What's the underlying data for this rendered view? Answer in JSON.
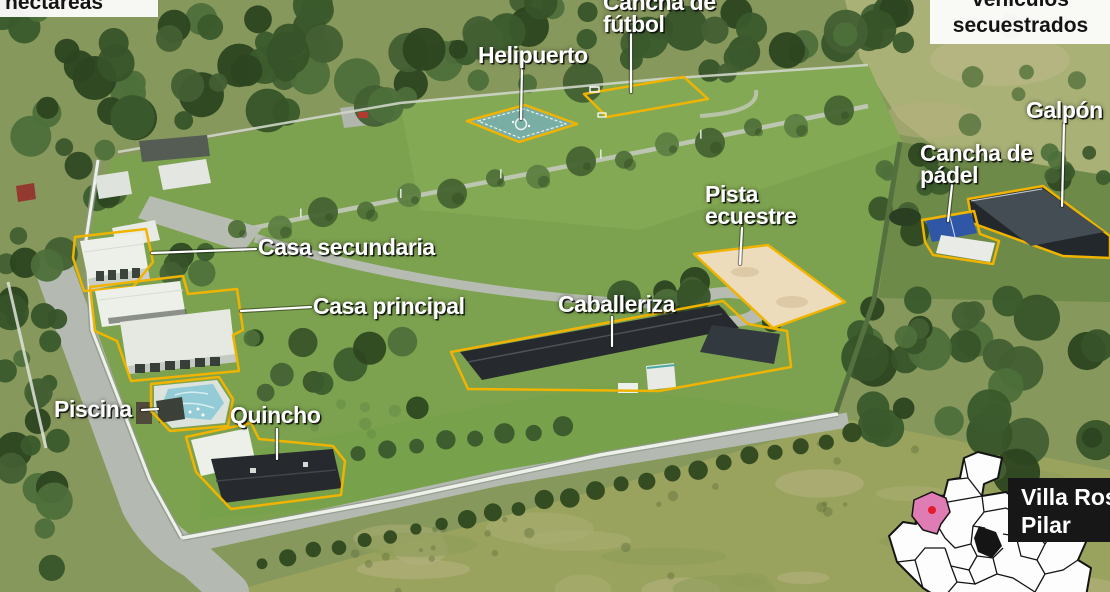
{
  "stats": {
    "hectareas_box": {
      "text": "hectáreas"
    },
    "vehiculos_box": {
      "line1": "vehículos",
      "line2": "secuestrados"
    }
  },
  "annotations": {
    "helipuerto": {
      "text": "Helipuerto"
    },
    "cancha_futbol": {
      "line1": "Cancha de",
      "line2": "fútbol"
    },
    "galpon": {
      "text": "Galpón"
    },
    "cancha_padel": {
      "line1": "Cancha de",
      "line2": "pádel"
    },
    "pista_ecuestre": {
      "line1": "Pista",
      "line2": "ecuestre"
    },
    "caballeriza": {
      "text": "Caballeriza"
    },
    "casa_secundaria": {
      "text": "Casa secundaria"
    },
    "casa_principal": {
      "text": "Casa principal"
    },
    "piscina": {
      "text": "Piscina"
    },
    "quincho": {
      "text": "Quincho"
    }
  },
  "map_inset": {
    "location_line1": "Villa Rosa",
    "location_line2": "Pilar",
    "highlight_color": "#e07cb4",
    "marker_color": "#e41b2c",
    "label_bg": "#171717"
  },
  "colors": {
    "feature_outline_yellow": "#f0b400",
    "label_text": "#ffffff",
    "stat_box_bg": "#fbfbfb",
    "stat_box_text": "#141414",
    "helipad_teal": "#79aea5",
    "padel_blue": "#2f57a5",
    "equestrian_sand": "#ecdcbb",
    "lawn_green": "#7ca24f"
  }
}
